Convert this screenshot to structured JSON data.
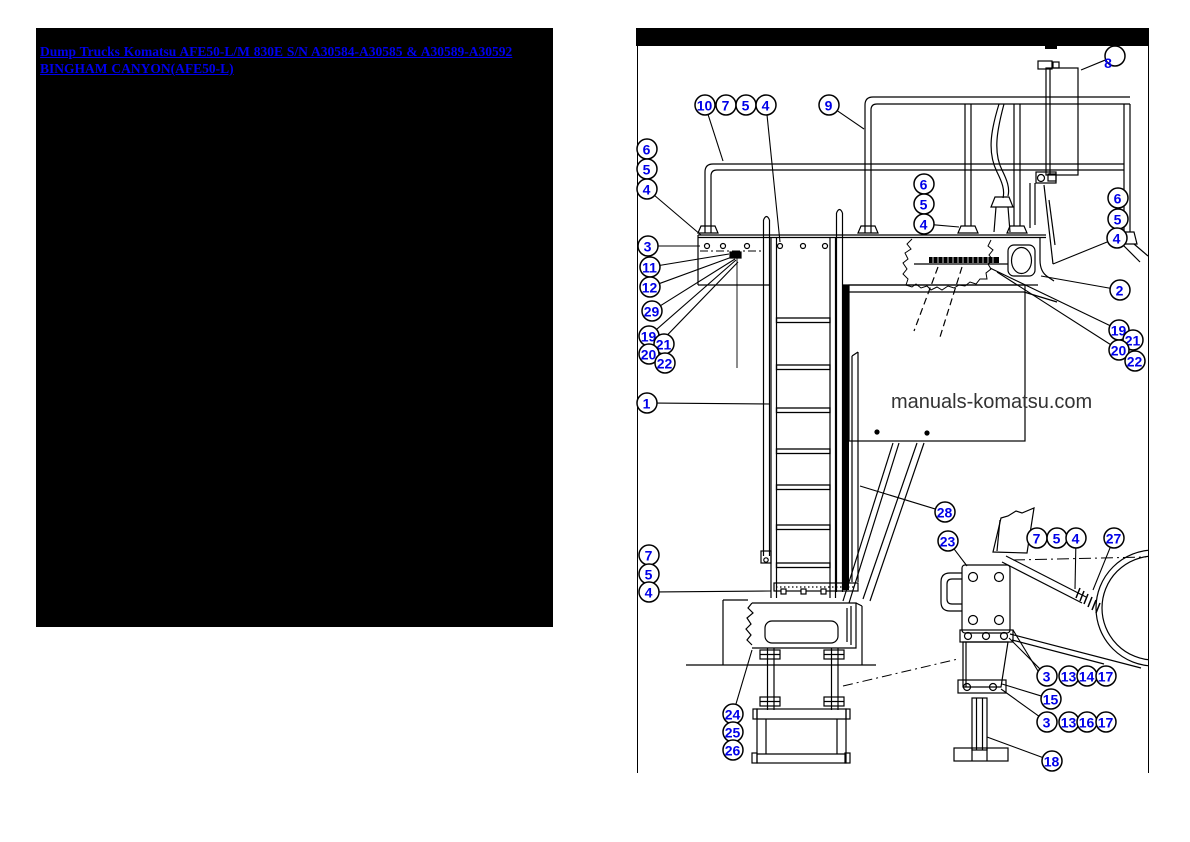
{
  "header": {
    "link_text": "Dump Trucks Komatsu AFE50-L/M 830E S/N A30584-A30585 & A30589-A30592 BINGHAM CANYON(AFE50-L)",
    "link_color": "#0000EE",
    "panel_bg": "#000000"
  },
  "diagram": {
    "watermark": "manuals-komatsu.com",
    "watermark_color": "#333333",
    "line_color": "#000000",
    "callout_color": "#0000E8",
    "callouts": [
      {
        "label": "10",
        "x": 705,
        "y": 105,
        "leader": [
          723,
          161
        ]
      },
      {
        "label": "7",
        "x": 726,
        "y": 105
      },
      {
        "label": "5",
        "x": 746,
        "y": 105
      },
      {
        "label": "4",
        "x": 766,
        "y": 105,
        "leader": [
          780,
          242
        ]
      },
      {
        "label": "9",
        "x": 829,
        "y": 105,
        "leader": [
          864,
          129
        ]
      },
      {
        "label": "8",
        "x": 1115,
        "y": 56,
        "tx": -7,
        "ty": 7,
        "leader": [
          1081,
          70
        ]
      },
      {
        "label": "6",
        "x": 647,
        "y": 149
      },
      {
        "label": "5",
        "x": 647,
        "y": 169
      },
      {
        "label": "4",
        "x": 647,
        "y": 189,
        "leader": [
          701,
          235
        ]
      },
      {
        "label": "6",
        "x": 924,
        "y": 184
      },
      {
        "label": "5",
        "x": 924,
        "y": 204
      },
      {
        "label": "4",
        "x": 924,
        "y": 224,
        "leader": [
          959,
          227
        ]
      },
      {
        "label": "6",
        "x": 1118,
        "y": 198
      },
      {
        "label": "5",
        "x": 1118,
        "y": 219
      },
      {
        "label": "4",
        "x": 1117,
        "y": 238,
        "leader": [
          1053,
          264
        ]
      },
      {
        "label": "3",
        "x": 648,
        "y": 246,
        "leader": [
          700,
          246
        ]
      },
      {
        "label": "11",
        "x": 650,
        "y": 267,
        "leader": [
          729,
          254
        ]
      },
      {
        "label": "12",
        "x": 650,
        "y": 287,
        "leader": [
          732,
          257
        ]
      },
      {
        "label": "29",
        "x": 652,
        "y": 311,
        "leader": [
          735,
          259
        ]
      },
      {
        "label": "19",
        "x": 649,
        "y": 336,
        "leader": [
          736,
          260
        ]
      },
      {
        "label": "21",
        "x": 664,
        "y": 344
      },
      {
        "label": "20",
        "x": 649,
        "y": 354,
        "leader": [
          738,
          262
        ]
      },
      {
        "label": "22",
        "x": 665,
        "y": 363
      },
      {
        "label": "2",
        "x": 1120,
        "y": 290,
        "leader": [
          1041,
          276
        ]
      },
      {
        "label": "19",
        "x": 1119,
        "y": 330,
        "leader": [
          990,
          268
        ]
      },
      {
        "label": "21",
        "x": 1133,
        "y": 340
      },
      {
        "label": "20",
        "x": 1119,
        "y": 350,
        "leader": [
          997,
          272
        ]
      },
      {
        "label": "22",
        "x": 1135,
        "y": 361
      },
      {
        "label": "1",
        "x": 647,
        "y": 403,
        "leader": [
          770,
          404
        ]
      },
      {
        "label": "28",
        "x": 945,
        "y": 512,
        "leader": [
          860,
          486
        ]
      },
      {
        "label": "7",
        "x": 649,
        "y": 555
      },
      {
        "label": "5",
        "x": 649,
        "y": 574
      },
      {
        "label": "4",
        "x": 649,
        "y": 592,
        "leader": [
          771,
          591
        ]
      },
      {
        "label": "23",
        "x": 948,
        "y": 541,
        "leader": [
          967,
          566
        ]
      },
      {
        "label": "7",
        "x": 1037,
        "y": 538
      },
      {
        "label": "5",
        "x": 1057,
        "y": 538
      },
      {
        "label": "4",
        "x": 1076,
        "y": 538,
        "leader": [
          1075,
          589
        ]
      },
      {
        "label": "27",
        "x": 1114,
        "y": 538,
        "leader": [
          1093,
          590
        ]
      },
      {
        "label": "3",
        "x": 1047,
        "y": 676,
        "leader": [
          1009,
          638
        ]
      },
      {
        "label": "13",
        "x": 1069,
        "y": 676
      },
      {
        "label": "14",
        "x": 1087,
        "y": 676
      },
      {
        "label": "17",
        "x": 1106,
        "y": 676
      },
      {
        "label": "15",
        "x": 1051,
        "y": 699,
        "leader": [
          1002,
          684
        ]
      },
      {
        "label": "3",
        "x": 1047,
        "y": 722,
        "leader": [
          1001,
          689
        ]
      },
      {
        "label": "13",
        "x": 1069,
        "y": 722
      },
      {
        "label": "16",
        "x": 1087,
        "y": 722
      },
      {
        "label": "17",
        "x": 1106,
        "y": 722
      },
      {
        "label": "18",
        "x": 1052,
        "y": 761,
        "leader": [
          987,
          737
        ]
      },
      {
        "label": "24",
        "x": 733,
        "y": 714,
        "leader": [
          752,
          650
        ]
      },
      {
        "label": "25",
        "x": 733,
        "y": 732
      },
      {
        "label": "26",
        "x": 733,
        "y": 750
      }
    ],
    "extra_leaders": [
      [
        1038,
        671,
        1013,
        630
      ]
    ]
  }
}
